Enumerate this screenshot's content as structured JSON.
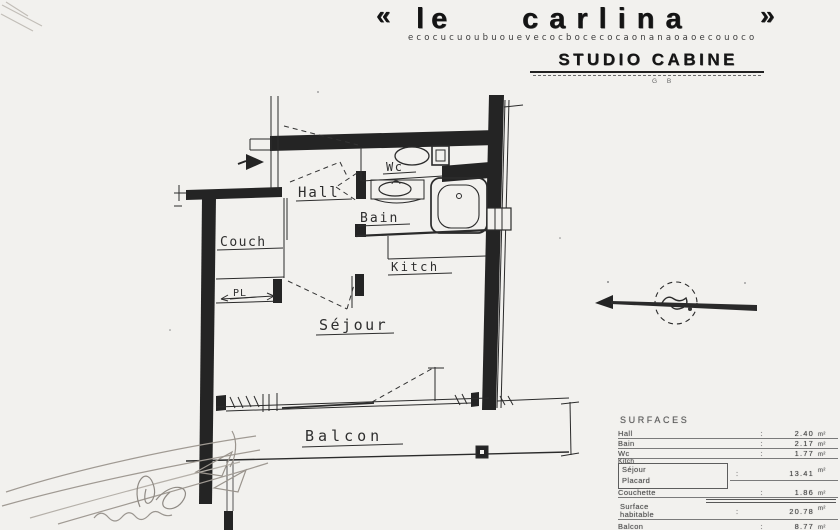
{
  "title": {
    "quote_open": "«",
    "word1": "le",
    "word2": "carlina",
    "quote_close": "»",
    "decorative_glyphs": "ecocucuoubuouevecocbocecocaonanaoaoecouoco",
    "subtitle": "STUDIO CABINE",
    "note": "G B"
  },
  "plan": {
    "labels": {
      "hall": "Hall",
      "wc": "Wc",
      "bain": "Bain",
      "couch": "Couch",
      "placard": "PL",
      "kitch": "Kitch",
      "sejour": "Séjour",
      "balcon": "Balcon"
    }
  },
  "surfaces": {
    "header": "SURFACES",
    "rows": {
      "hall": {
        "label": "Hall",
        "value": "2.40",
        "unit": "m²"
      },
      "bain": {
        "label": "Bain",
        "value": "2.17",
        "unit": "m²"
      },
      "wc": {
        "label": "Wc",
        "value": "1.77",
        "unit": "m²"
      },
      "kitch": {
        "label": "Kitch"
      },
      "sejour_placard": {
        "label1": "Séjour",
        "label2": "Placard",
        "value": "13.41",
        "unit": "m²"
      },
      "couchette": {
        "label": "Couchette",
        "value": "1.86",
        "unit": "m²"
      },
      "habitable": {
        "label1": "Surface",
        "label2": "habitable",
        "value": "20.78",
        "unit": "m²"
      },
      "balcon": {
        "label": "Balcon",
        "value": "8.77",
        "unit": "m²"
      }
    }
  },
  "colors": {
    "ink": "#262626",
    "paper": "#f2f1ee"
  }
}
